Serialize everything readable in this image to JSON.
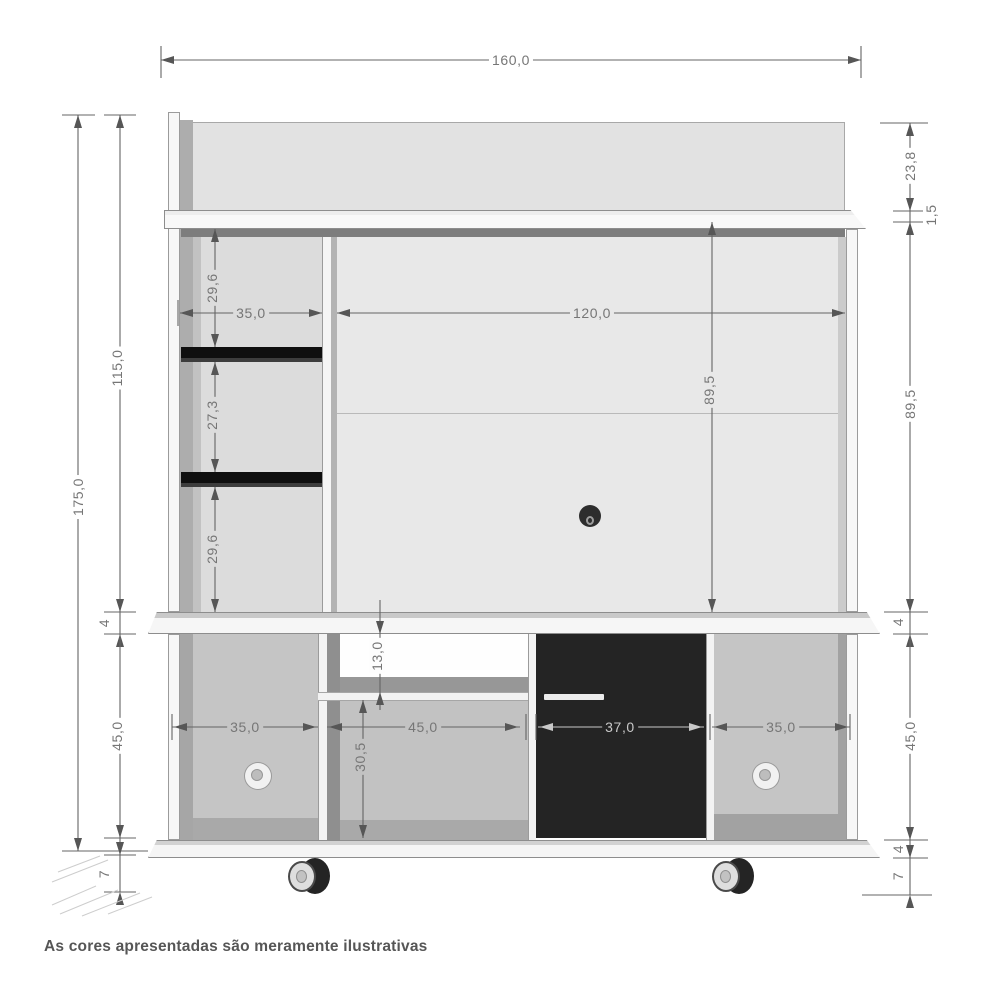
{
  "drawing": {
    "title": "Painel home theater - desenho técnico com medidas",
    "footer_note": "As cores apresentadas são meramente ilustrativas",
    "unit": "cm"
  },
  "colors": {
    "panel_gray": "#e8e8e8",
    "column_gray": "#dcdcdc",
    "compartment_gray": "#c5c5c5",
    "shadow_gray": "#7d7d7d",
    "door_black": "#242424",
    "shelf_black": "#141414",
    "dim_line": "#646464",
    "dim_text": "#767676",
    "note_text": "#565656"
  },
  "dimensions": {
    "total_width": "160,0",
    "total_height": "175,0",
    "upper_section_height": "115,0",
    "top_panel_height": "23,8",
    "top_shelf_thickness": "1,5",
    "back_panel_width": "120,0",
    "back_panel_height_inner": "89,5",
    "back_panel_height_right": "89,5",
    "left_column_width": "35,0",
    "shelf_gap_top": "29,6",
    "shelf_gap_middle": "27,3",
    "shelf_gap_bottom": "29,6",
    "stand_top_thickness_left": "4",
    "stand_top_thickness_right": "4",
    "base_height_left": "45,0",
    "base_height_right": "45,0",
    "base_plate_thickness_right": "4",
    "caster_height_left": "7",
    "caster_height_right": "7",
    "niche_upper_height": "13,0",
    "niche_lower_height": "30,5",
    "base_left_compartment_width": "35,0",
    "base_middle_compartment_width": "45,0",
    "door_width": "37,0",
    "base_right_compartment_width": "35,0"
  }
}
